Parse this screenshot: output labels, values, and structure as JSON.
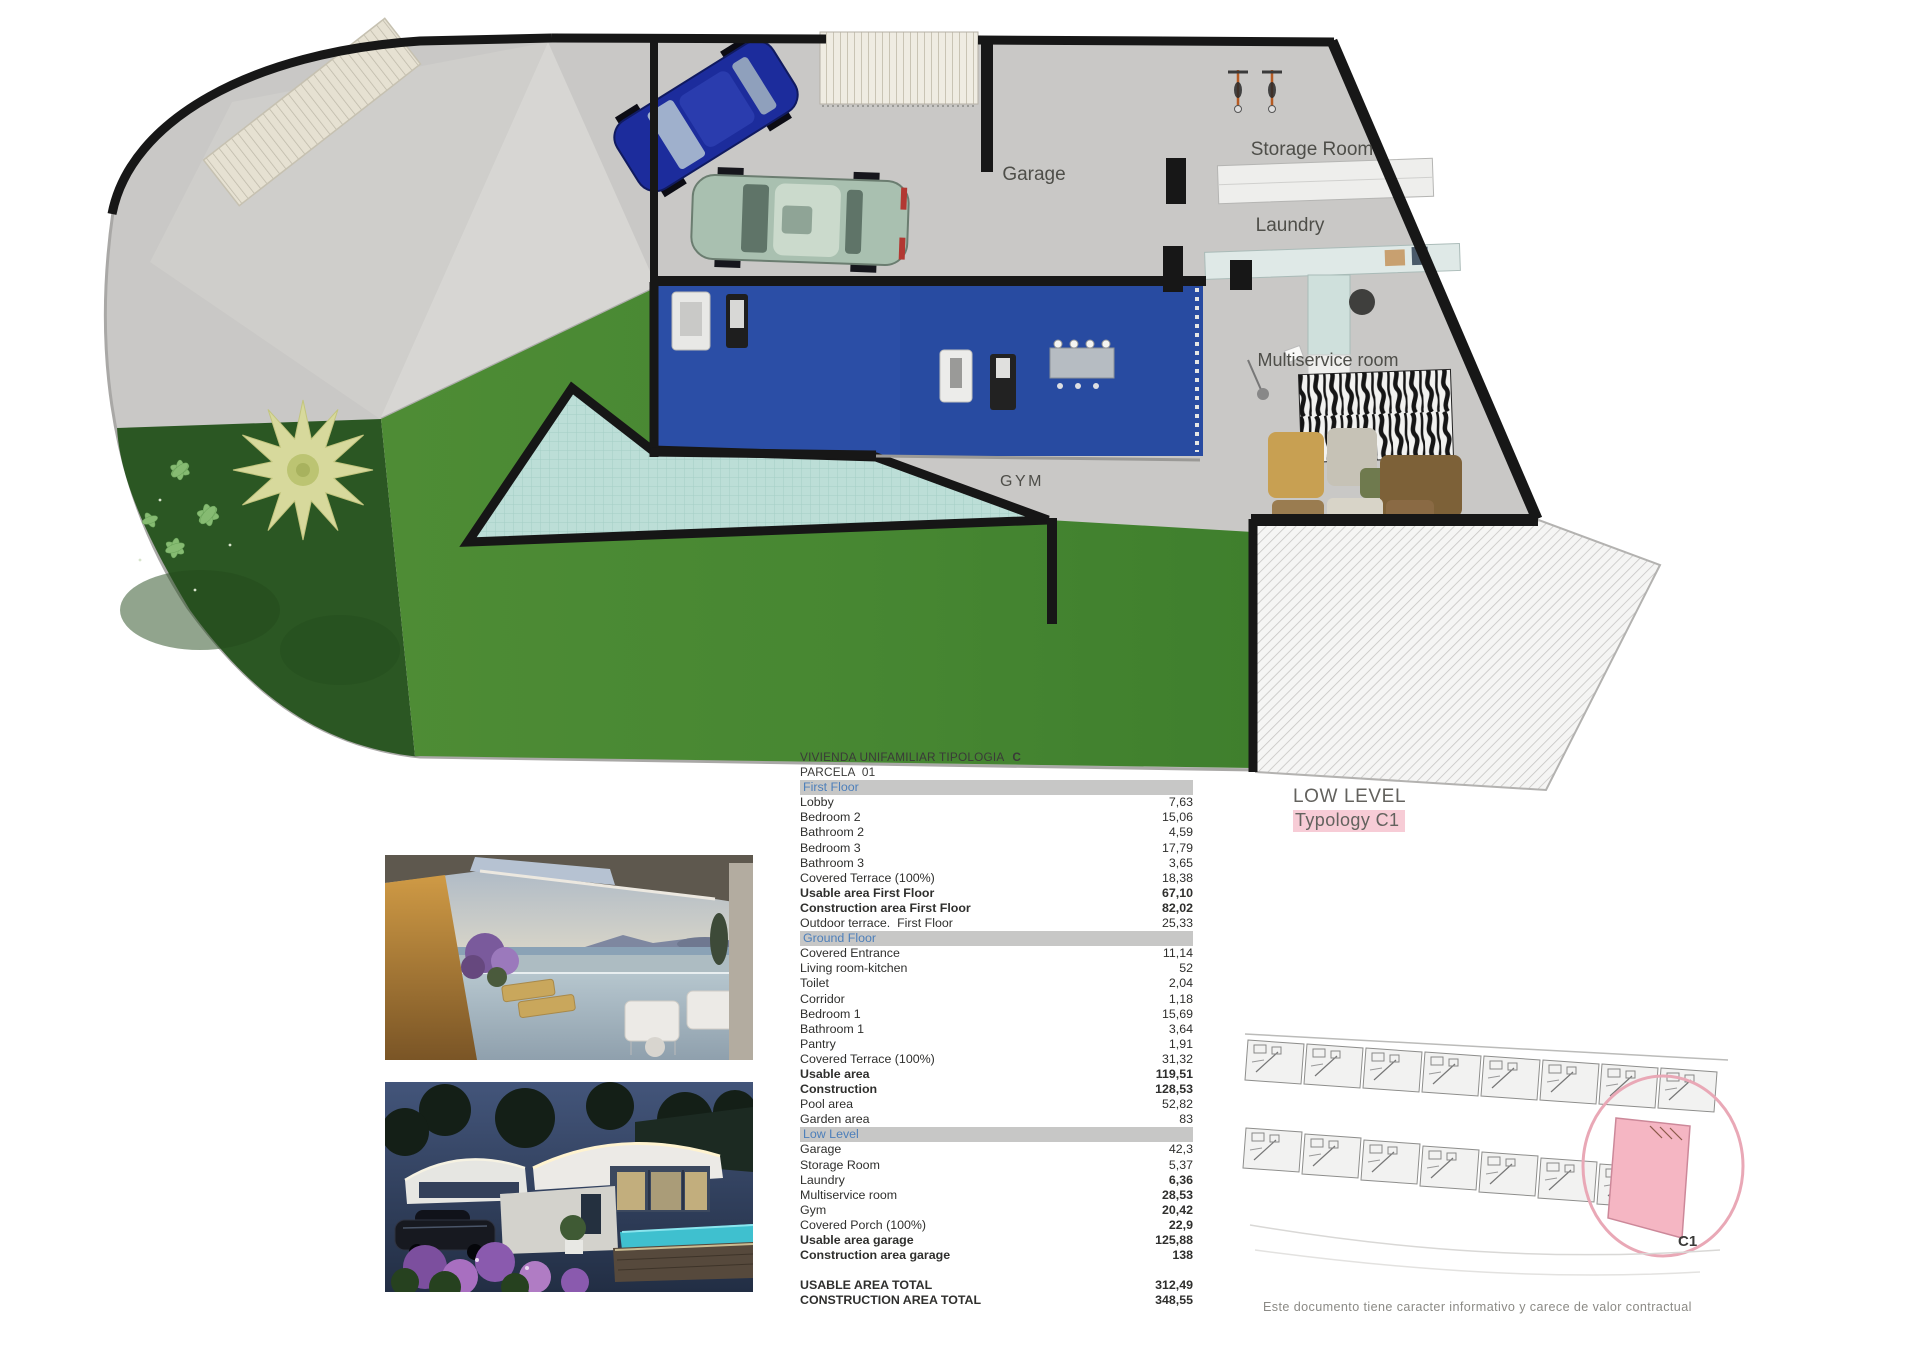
{
  "plan": {
    "labels": {
      "garage": "Garage",
      "storage": "Storage Room",
      "laundry": "Laundry",
      "multiservice": "Multiservice room",
      "gym": "GYM"
    },
    "level_title": "LOW LEVEL",
    "typology": "Typology C1"
  },
  "site_plan": {
    "unit_label": "C1"
  },
  "table": {
    "title": "VIVIENDA UNIFAMILIAR TIPOLOGIA",
    "title_suffix": "C",
    "subtitle": "PARCELA  01",
    "sections": [
      {
        "header": "First Floor",
        "rows": [
          {
            "label": "Lobby",
            "value": "7,63"
          },
          {
            "label": "Bedroom 2",
            "value": "15,06"
          },
          {
            "label": "Bathroom 2",
            "value": "4,59"
          },
          {
            "label": "Bedroom 3",
            "value": "17,79"
          },
          {
            "label": "Bathroom 3",
            "value": "3,65"
          },
          {
            "label": "Covered Terrace (100%)",
            "value": "18,38"
          },
          {
            "label": "Usable area First Floor",
            "value": "67,10",
            "bold": "both"
          },
          {
            "label": "Construction area First Floor",
            "value": "82,02",
            "bold": "both"
          },
          {
            "label": "Outdoor terrace.  First Floor",
            "value": "25,33"
          }
        ]
      },
      {
        "header": "Ground Floor",
        "rows": [
          {
            "label": "Covered Entrance",
            "value": "11,14"
          },
          {
            "label": "Living room-kitchen",
            "value": "52"
          },
          {
            "label": "Toilet",
            "value": "2,04"
          },
          {
            "label": "Corridor",
            "value": "1,18"
          },
          {
            "label": "Bedroom 1",
            "value": "15,69"
          },
          {
            "label": "Bathroom 1",
            "value": "3,64"
          },
          {
            "label": "Pantry",
            "value": "1,91"
          },
          {
            "label": "Covered Terrace (100%)",
            "value": "31,32"
          },
          {
            "label": "Usable area",
            "value": "119,51",
            "bold": "both"
          },
          {
            "label": "Construction",
            "value": "128,53",
            "bold": "both"
          },
          {
            "label": "Pool area",
            "value": "52,82"
          },
          {
            "label": "Garden area",
            "value": "83"
          }
        ]
      },
      {
        "header": "Low Level",
        "rows": [
          {
            "label": "Garage",
            "value": "42,3"
          },
          {
            "label": "Storage Room",
            "value": "5,37"
          },
          {
            "label": "Laundry",
            "value": "6,36",
            "bold": "value"
          },
          {
            "label": "Multiservice room",
            "value": "28,53",
            "bold": "value"
          },
          {
            "label": "Gym",
            "value": "20,42",
            "bold": "value"
          },
          {
            "label": "Covered Porch (100%)",
            "value": "22,9",
            "bold": "value"
          },
          {
            "label": "Usable area garage",
            "value": "125,88",
            "bold": "both"
          },
          {
            "label": "Construction area garage",
            "value": "138",
            "bold": "both"
          }
        ]
      }
    ],
    "totals": [
      {
        "label": "USABLE AREA TOTAL",
        "value": "312,49"
      },
      {
        "label": "CONSTRUCTION AREA TOTAL",
        "value": "348,55"
      }
    ]
  },
  "footer": {
    "disclaimer": "Este documento tiene caracter informativo y carece de valor contractual"
  },
  "colors": {
    "grass": "#4e8c35",
    "garden": "#2b5723",
    "pool": "#bcded7",
    "gym_mat": "#2b4ea6",
    "wall": "#171717",
    "section_header_bg": "#c7c7c6",
    "section_header_text": "#4d7fba",
    "typology_highlight": "#f7ccd6",
    "site_unit_highlight": "#f5b6c3"
  }
}
